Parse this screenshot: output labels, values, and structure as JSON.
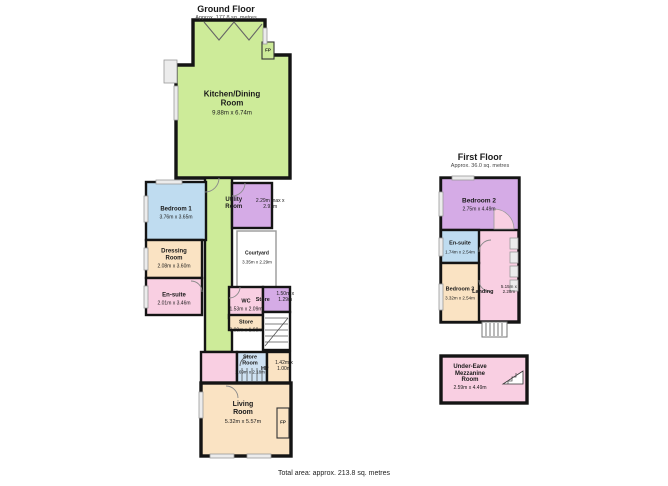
{
  "palette": {
    "green": "#cdeb99",
    "blue": "#bfdcf0",
    "blue2": "#cfe2f3",
    "tan": "#fae3c3",
    "pink": "#f9cfe2",
    "purple": "#d5abe6"
  },
  "footer": {
    "total_area": "Total area: approx. 213.8 sq. metres"
  },
  "ground_floor": {
    "title": "Ground Floor",
    "area": "Approx. 177.8 sq. metres",
    "rooms": {
      "kitchen": {
        "label": "Kitchen/Dining Room",
        "dims": "9.88m x 6.74m"
      },
      "bedroom1": {
        "label": "Bedroom 1",
        "dims": "3.76m x 3.65m"
      },
      "dressing": {
        "label": "Dressing Room",
        "dims": "2.08m x 3.60m"
      },
      "ensuite": {
        "label": "En-suite",
        "dims": "2.01m x 3.46m"
      },
      "utility": {
        "label": "Utility Room",
        "dims": "2.29m max x 2.91m"
      },
      "courtyard": {
        "label": "Courtyard",
        "dims": "3.35m x 2.29m"
      },
      "wc": {
        "label": "WC",
        "dims": "1.53m x 2.09m"
      },
      "store_upper": {
        "label": "Store",
        "dims": "1.50m x 1.29m"
      },
      "store_lower": {
        "label": "Store",
        "dims": "0.90m x 1.98m"
      },
      "store_room": {
        "label": "Store Room",
        "dims": "1.69m x 2.18m"
      },
      "hp": {
        "label": "HP",
        "dims": "1.42m x 1.00m"
      },
      "living": {
        "label": "Living Room",
        "dims": "5.32m x 5.57m"
      },
      "fp_kitchen": {
        "label": "FP"
      },
      "fp_living": {
        "label": "FP"
      }
    }
  },
  "first_floor": {
    "title": "First Floor",
    "area": "Approx. 36.0 sq. metres",
    "rooms": {
      "bedroom2": {
        "label": "Bedroom 2",
        "dims": "2.75m x 4.49m"
      },
      "ensuite": {
        "label": "En-suite",
        "dims": "1.74m x 2.54m"
      },
      "bedroom3": {
        "label": "Bedroom 3",
        "dims": "3.32m x 2.54m"
      },
      "landing": {
        "label": "Landing",
        "dims": "5.15m x 2.28m"
      }
    }
  },
  "mezzanine": {
    "label": "Under-Eave Mezzanine Room",
    "dims": "2.59m x 4.49m"
  }
}
